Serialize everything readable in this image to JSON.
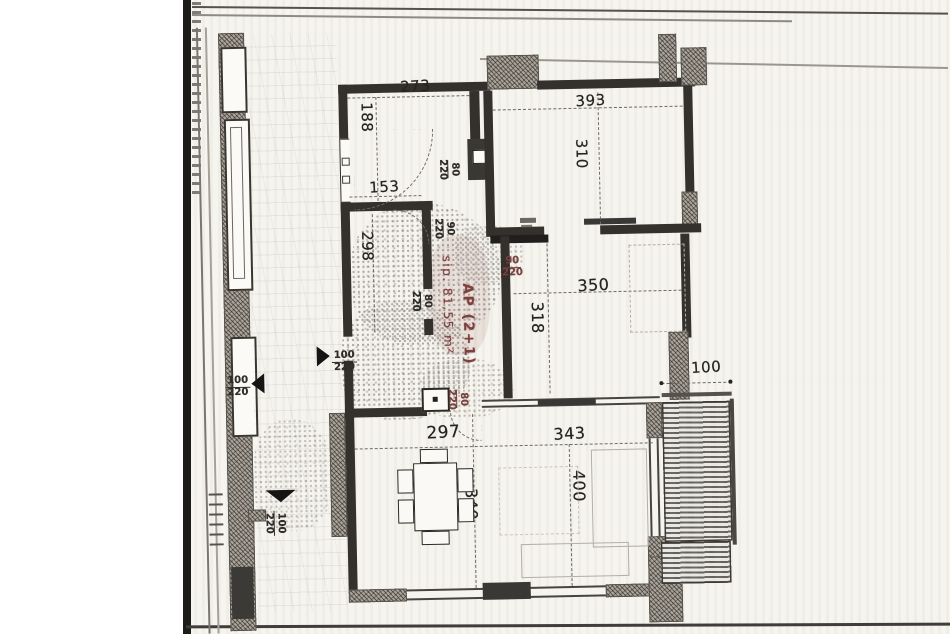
{
  "colors": {
    "ink": "#2a2825",
    "red": "#7d4240",
    "paper": "#f6f4ee",
    "wall": "#34312d"
  },
  "apartment": {
    "area_label": "sip. 81,55 m²",
    "type_label": "AP (2+1)"
  },
  "dimensions": [
    {
      "text": "273"
    },
    {
      "text": "188"
    },
    {
      "text": "393"
    },
    {
      "text": "310"
    },
    {
      "text": "153"
    },
    {
      "text": "298"
    },
    {
      "text": "350"
    },
    {
      "text": "318"
    },
    {
      "text": "100"
    },
    {
      "text": "297"
    },
    {
      "text": "343"
    },
    {
      "text": "340"
    },
    {
      "text": "400"
    }
  ],
  "doors": [
    {
      "num": "80",
      "den": "220"
    },
    {
      "num": "90",
      "den": "220"
    },
    {
      "num": "90",
      "den": "220"
    },
    {
      "num": "80",
      "den": "220"
    },
    {
      "num": "80",
      "den": "220"
    },
    {
      "num": "100",
      "den": "220"
    },
    {
      "num": "100",
      "den": "220"
    },
    {
      "num": "100",
      "den": "220"
    }
  ]
}
